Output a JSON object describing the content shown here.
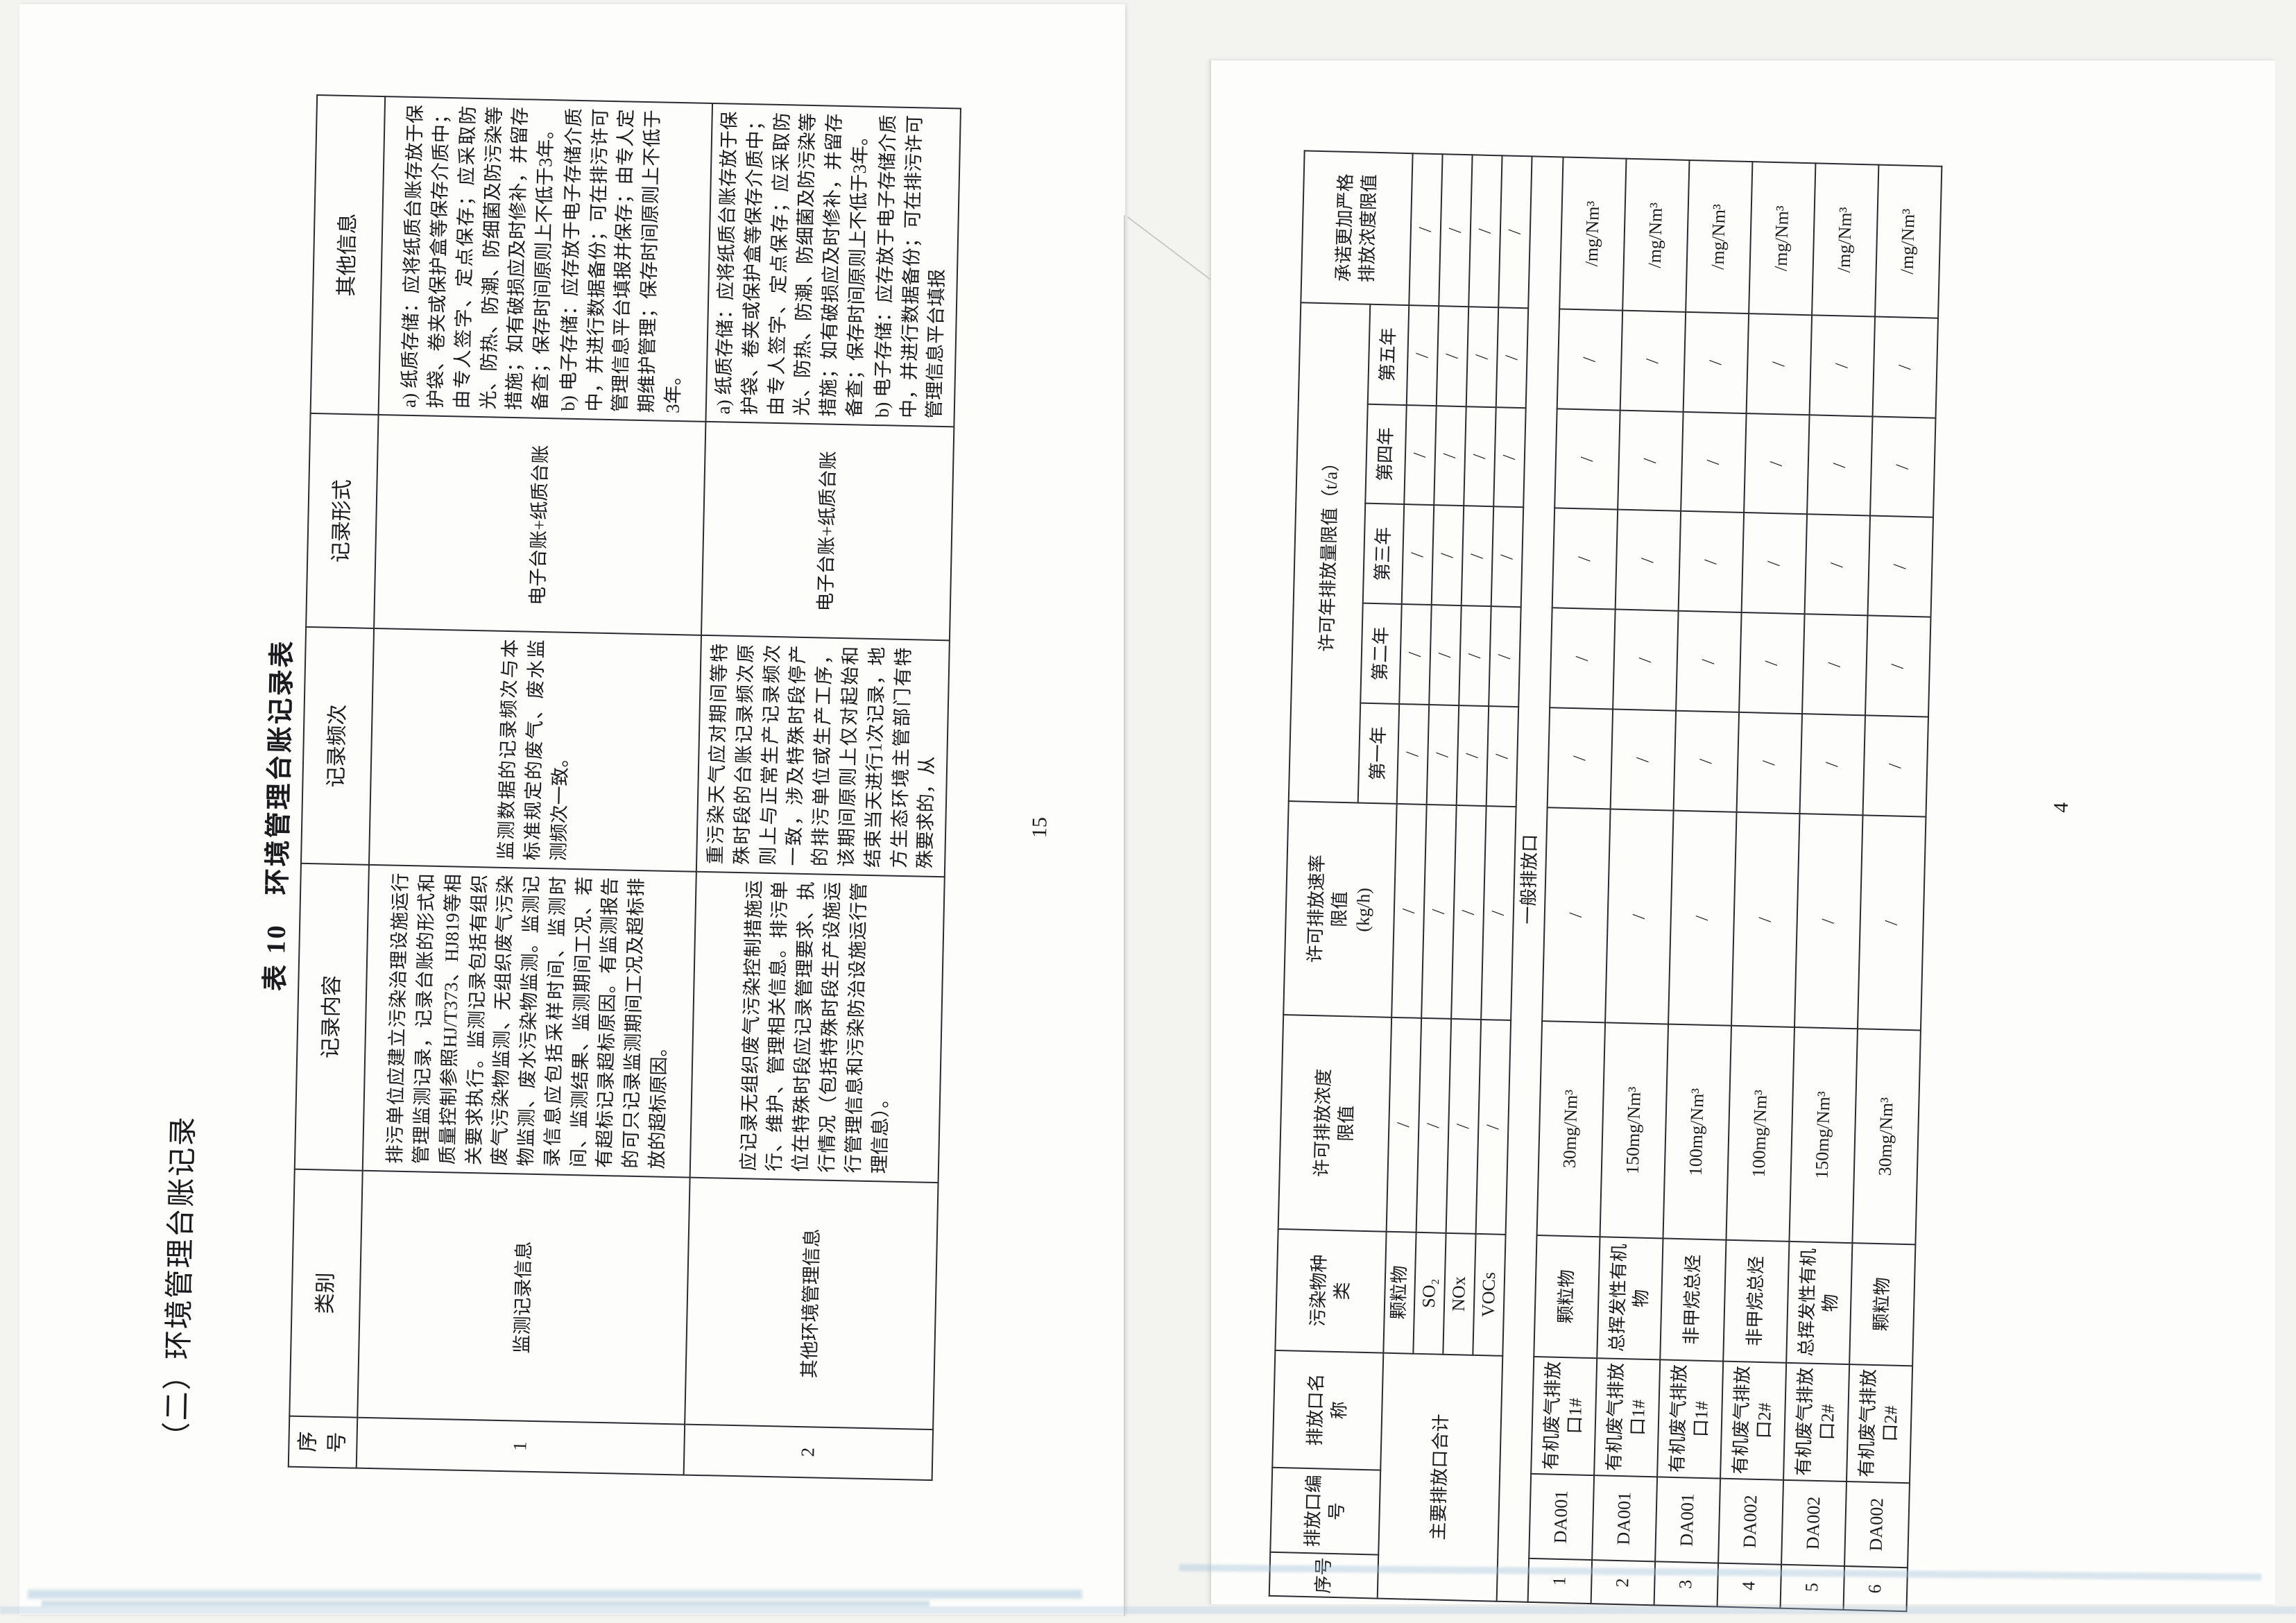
{
  "document": {
    "kind": "scanned pollutant discharge permit spread, two pages rotated 90 degrees",
    "paper_color": "#fdfdfb",
    "ink_color": "#1b1b1f",
    "table_line_color": "#2b2b30",
    "artifact_blue": "#9bbed8"
  },
  "left_page": {
    "section_heading": "（二）环境管理台账记录",
    "table_caption": "表 10　环境管理台账记录表",
    "page_number": "15",
    "table": {
      "headers": [
        "序号",
        "类别",
        "记录内容",
        "记录频次",
        "记录形式",
        "其他信息"
      ],
      "rows": [
        {
          "seq": "1",
          "category": "监测记录信息",
          "content": "排污单位应建立污染治理设施运行管理监测记录，记录台账的形式和质量控制参照HJ/T373、HJ819等相关要求执行。监测记录包括有组织废气污染物监测、无组织废气污染物监测、废水污染物监测。监测记录信息应包括采样时间、监测时间、监测结果、监测期间工况、若有超标记录超标原因。有监测报告的可只记录监测期间工况及超标排放的超标原因。",
          "frequency": "监测数据的记录频次与本标准规定的废气、废水监测频次一致。",
          "form": "电子台账+纸质台账",
          "other": [
            "a) 纸质存储：应将纸质台账存放于保护袋、卷夹或保护盒等保存介质中；由专人签字、定点保存；应采取防光、防热、防潮、防细菌及防污染等措施；如有破损应及时修补，并留存备查；保存时间原则上不低于3年。",
            "b) 电子存储：应存放于电子存储介质中，并进行数据备份；可在排污许可管理信息平台填报并保存；由专人定期维护管理；保存时间原则上不低于3年。"
          ]
        },
        {
          "seq": "2",
          "category": "其他环境管理信息",
          "content": "应记录无组织废气污染控制措施运行、维护、管理相关信息。排污单位在特殊时段应记录管理要求、执行情况（包括特殊时段生产设施运行管理信息和污染防治设施运行管理信息）。",
          "frequency": "重污染天气应对期间等特殊时段的台账记录频次原则上与正常生产记录频次一致，涉及特殊时段停产的排污单位或生产工序，该期间原则上仅对起始和结束当天进行1次记录，地方生态环境主管部门有特殊要求的，从",
          "form": "电子台账+纸质台账",
          "other": [
            "a) 纸质存储：应将纸质台账存放于保护袋、卷夹或保护盒等保存介质中；由专人签字、定点保存；应采取防光、防热、防潮、防细菌及防污染等措施；如有破损应及时修补，并留存备查；保存时间原则上不低于3年。",
            "b) 电子存储：应存放于电子存储介质中，并进行数据备份；可在排污许可管理信息平台填报"
          ]
        }
      ]
    }
  },
  "right_page": {
    "page_number": "4",
    "table": {
      "col_headers": [
        "序号",
        "排放口编\n号",
        "排放口名\n称",
        "污染物种\n类",
        "许可排放浓度\n限值",
        "许可排放速率\n限值\n(kg/h)"
      ],
      "annual_group_header": "许可年排放量限值（t/a）",
      "year_headers": [
        "第一年",
        "第二年",
        "第三年",
        "第四年",
        "第五年"
      ],
      "promise_header": "承诺更加严格\n排放浓度限值",
      "summary_label": "主要排放口合计",
      "summary_rows": [
        {
          "pollutant": "颗粒物",
          "concentration": "/",
          "rate": "/",
          "years": [
            "/",
            "/",
            "/",
            "/",
            "/"
          ],
          "promise": "/"
        },
        {
          "pollutant": "SO₂",
          "concentration": "/",
          "rate": "/",
          "years": [
            "/",
            "/",
            "/",
            "/",
            "/"
          ],
          "promise": "/"
        },
        {
          "pollutant": "NOx",
          "concentration": "/",
          "rate": "/",
          "years": [
            "/",
            "/",
            "/",
            "/",
            "/"
          ],
          "promise": "/"
        },
        {
          "pollutant": "VOCs",
          "concentration": "/",
          "rate": "/",
          "years": [
            "/",
            "/",
            "/",
            "/",
            "/"
          ],
          "promise": "/"
        }
      ],
      "section_label": "一般排放口",
      "rows": [
        {
          "seq": "1",
          "outlet_code": "DA001",
          "outlet_name": "有机废气排放口1#",
          "pollutant": "颗粒物",
          "concentration": "30mg/Nm³",
          "rate": "/",
          "years": [
            "/",
            "/",
            "/",
            "/",
            "/"
          ],
          "promise": "/mg/Nm³"
        },
        {
          "seq": "2",
          "outlet_code": "DA001",
          "outlet_name": "有机废气排放口1#",
          "pollutant": "总挥发性有机物",
          "concentration": "150mg/Nm³",
          "rate": "/",
          "years": [
            "/",
            "/",
            "/",
            "/",
            "/"
          ],
          "promise": "/mg/Nm³"
        },
        {
          "seq": "3",
          "outlet_code": "DA001",
          "outlet_name": "有机废气排放口1#",
          "pollutant": "非甲烷总烃",
          "concentration": "100mg/Nm³",
          "rate": "/",
          "years": [
            "/",
            "/",
            "/",
            "/",
            "/"
          ],
          "promise": "/mg/Nm³"
        },
        {
          "seq": "4",
          "outlet_code": "DA002",
          "outlet_name": "有机废气排放口2#",
          "pollutant": "非甲烷总烃",
          "concentration": "100mg/Nm³",
          "rate": "/",
          "years": [
            "/",
            "/",
            "/",
            "/",
            "/"
          ],
          "promise": "/mg/Nm³"
        },
        {
          "seq": "5",
          "outlet_code": "DA002",
          "outlet_name": "有机废气排放口2#",
          "pollutant": "总挥发性有机物",
          "concentration": "150mg/Nm³",
          "rate": "/",
          "years": [
            "/",
            "/",
            "/",
            "/",
            "/"
          ],
          "promise": "/mg/Nm³"
        },
        {
          "seq": "6",
          "outlet_code": "DA002",
          "outlet_name": "有机废气排放口2#",
          "pollutant": "颗粒物",
          "concentration": "30mg/Nm³",
          "rate": "/",
          "years": [
            "/",
            "/",
            "/",
            "/",
            "/"
          ],
          "promise": "/mg/Nm³"
        }
      ]
    }
  }
}
